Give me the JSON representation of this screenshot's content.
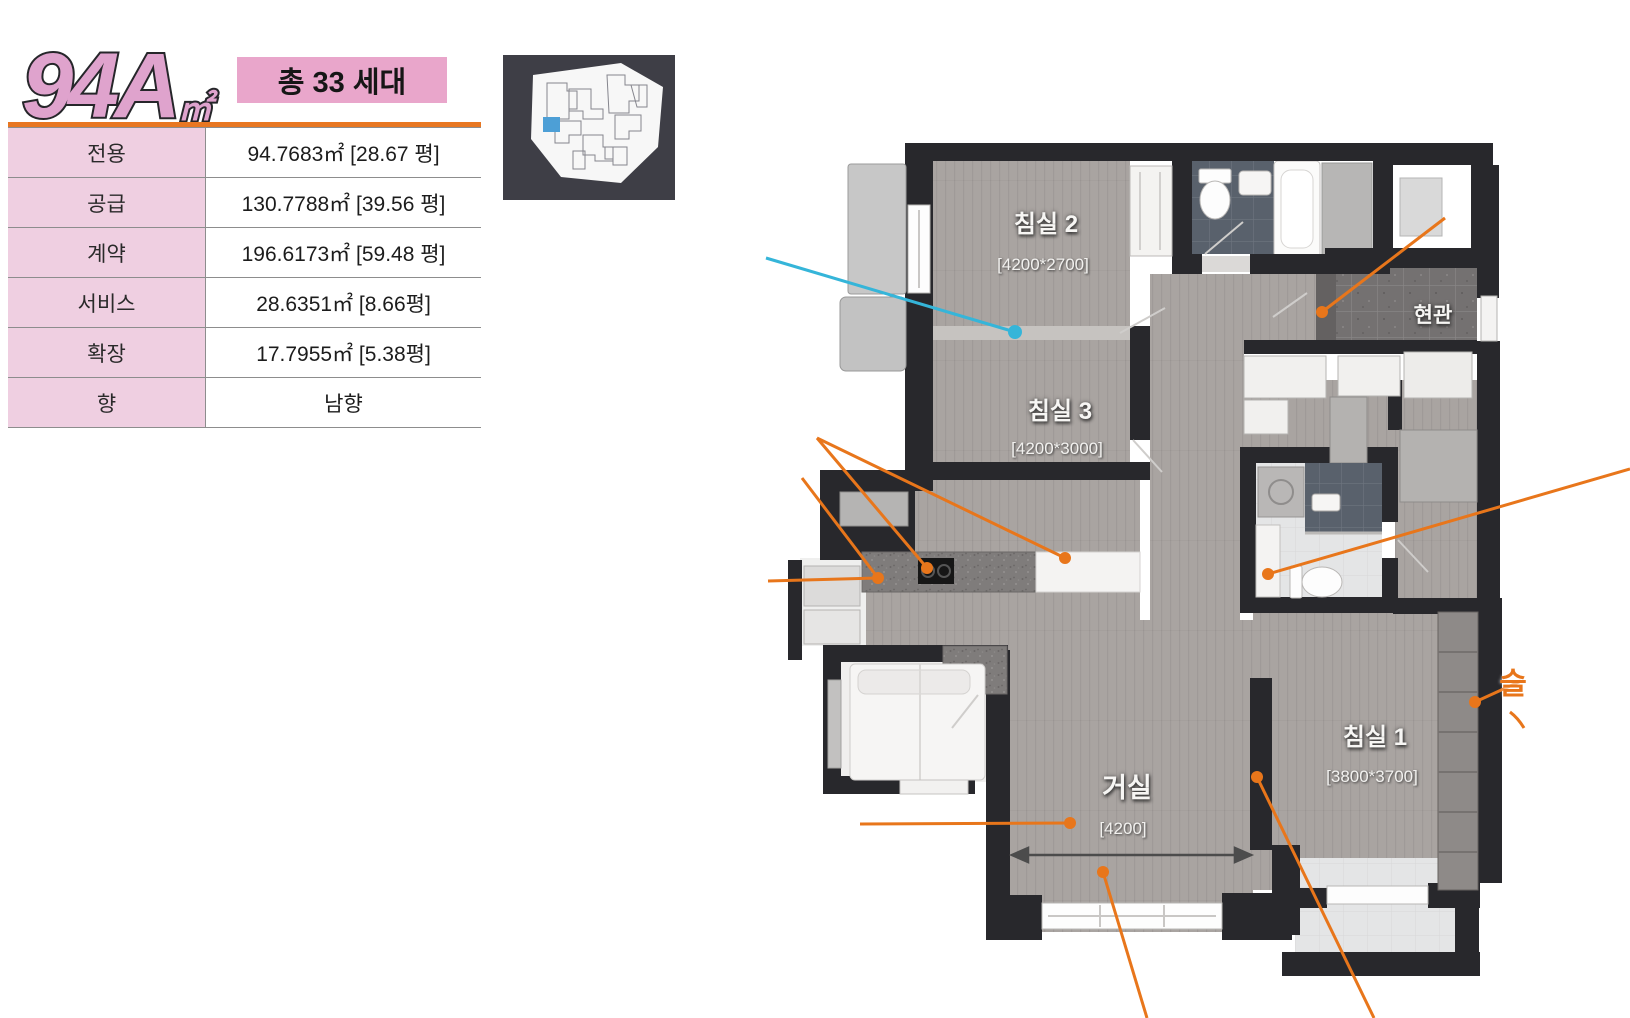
{
  "header": {
    "plan_code": "94A",
    "plan_code_unit": "㎡",
    "badge": "총 33 세대"
  },
  "info_table": {
    "rows": [
      {
        "label": "전용",
        "value": "94.7683㎡ [28.67 평]"
      },
      {
        "label": "공급",
        "value": "130.7788㎡ [39.56 평]"
      },
      {
        "label": "계약",
        "value": "196.6173㎡ [59.48 평]"
      },
      {
        "label": "서비스",
        "value": "28.6351㎡ [8.66평]"
      },
      {
        "label": "확장",
        "value": "17.7955㎡ [5.38평]"
      },
      {
        "label": "향",
        "value": "남향"
      }
    ]
  },
  "floor_plan": {
    "rooms": [
      {
        "id": "bedroom2",
        "label": "침실 2",
        "dim": "[4200*2700]"
      },
      {
        "id": "bedroom3",
        "label": "침실 3",
        "dim": "[4200*3000]"
      },
      {
        "id": "bedroom1",
        "label": "침실 1",
        "dim": "[3800*3700]"
      },
      {
        "id": "living",
        "label": "거실",
        "dim": "[4200]"
      },
      {
        "id": "entrance",
        "label": "현관",
        "dim": ""
      }
    ],
    "annotation_fragment": "슬",
    "colors": {
      "orange": "#e8761b",
      "cyan": "#35b5d9",
      "badge_pink": "#e9a6cb",
      "table_pink": "#efcfe1",
      "divider_orange": "#e87722",
      "wall": "#28282c",
      "sitemap_highlight": "#4d9fd6"
    }
  }
}
